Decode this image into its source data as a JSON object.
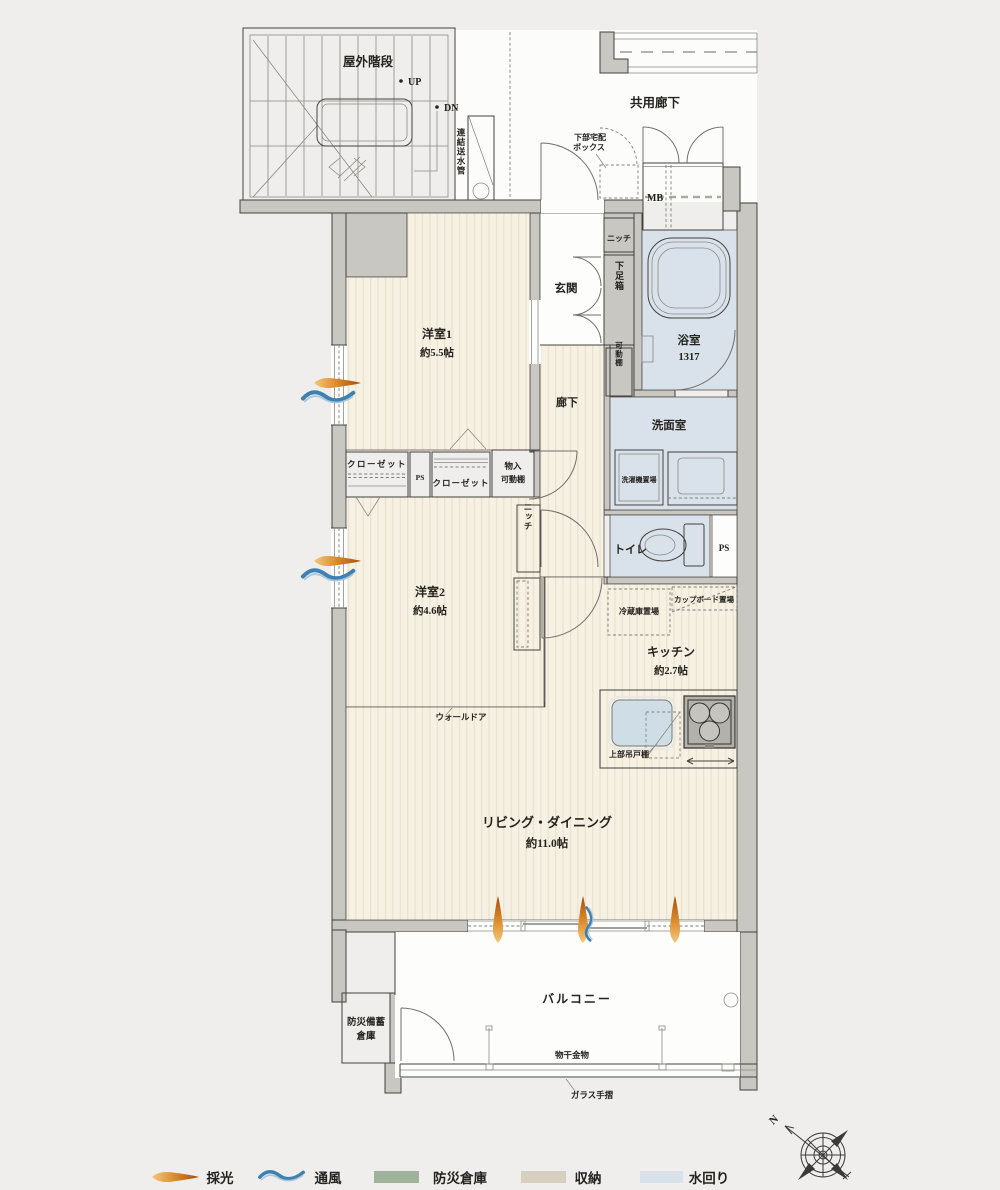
{
  "palette": {
    "background": "#efeeec",
    "wall": "#c9c7c2",
    "floor": "#f6f1e2",
    "floor_stripe": "#eae3d1",
    "water_area": "#d9e2ea",
    "storage_area": "#d7d0c0",
    "disaster_area": "#9fb29a",
    "daylight_accent": "#d3751f",
    "ventilation_accent": "#4080b0"
  },
  "ext": {
    "outdoor_stairs": "屋外階段",
    "up": "UP",
    "dn": "DN",
    "standpipe": "連結送水管",
    "common_corridor": "共用廊下",
    "delivery_line1": "下部宅配",
    "delivery_line2": "ボックス",
    "mb": "MB"
  },
  "rooms": {
    "bed1_name": "洋室1",
    "bed1_size": "約5.5帖",
    "bed2_name": "洋室2",
    "bed2_size": "約4.6帖",
    "ld_name": "リビング・ダイニング",
    "ld_size": "約11.0帖",
    "kitchen_name": "キッチン",
    "kitchen_size": "約2.7帖",
    "bath_name": "浴室",
    "bath_size": "1317",
    "washroom": "洗面室",
    "toilet": "トイレ",
    "entrance": "玄関",
    "hallway": "廊下",
    "balcony": "バルコニー"
  },
  "storage": {
    "niche_entrance": "ニッチ",
    "shoe_box": "下足箱",
    "movable_shelf": "可動棚",
    "closet1": "クローゼット",
    "closet2": "クローゼット",
    "ps_closet": "PS",
    "storage_line1": "物入",
    "storage_line2": "可動棚",
    "niche_bed2": "ニッチ",
    "ps_toilet": "PS",
    "disaster_line1": "防災備蓄",
    "disaster_line2": "倉庫"
  },
  "fixtures": {
    "washer": "洗濯機置場",
    "fridge": "冷蔵庫置場",
    "cupboard": "カップボード置場",
    "upper_cabinet": "上部吊戸棚",
    "wall_door": "ウォールドア",
    "fix_left": "FIX",
    "fix_right": "FIX",
    "laundry": "物干金物",
    "glass_rail": "ガラス手摺"
  },
  "legend": {
    "daylight": "採光",
    "ventilation": "通風",
    "disaster": "防災倉庫",
    "storage": "収納",
    "water": "水回り"
  },
  "compass": {
    "north": "N"
  }
}
